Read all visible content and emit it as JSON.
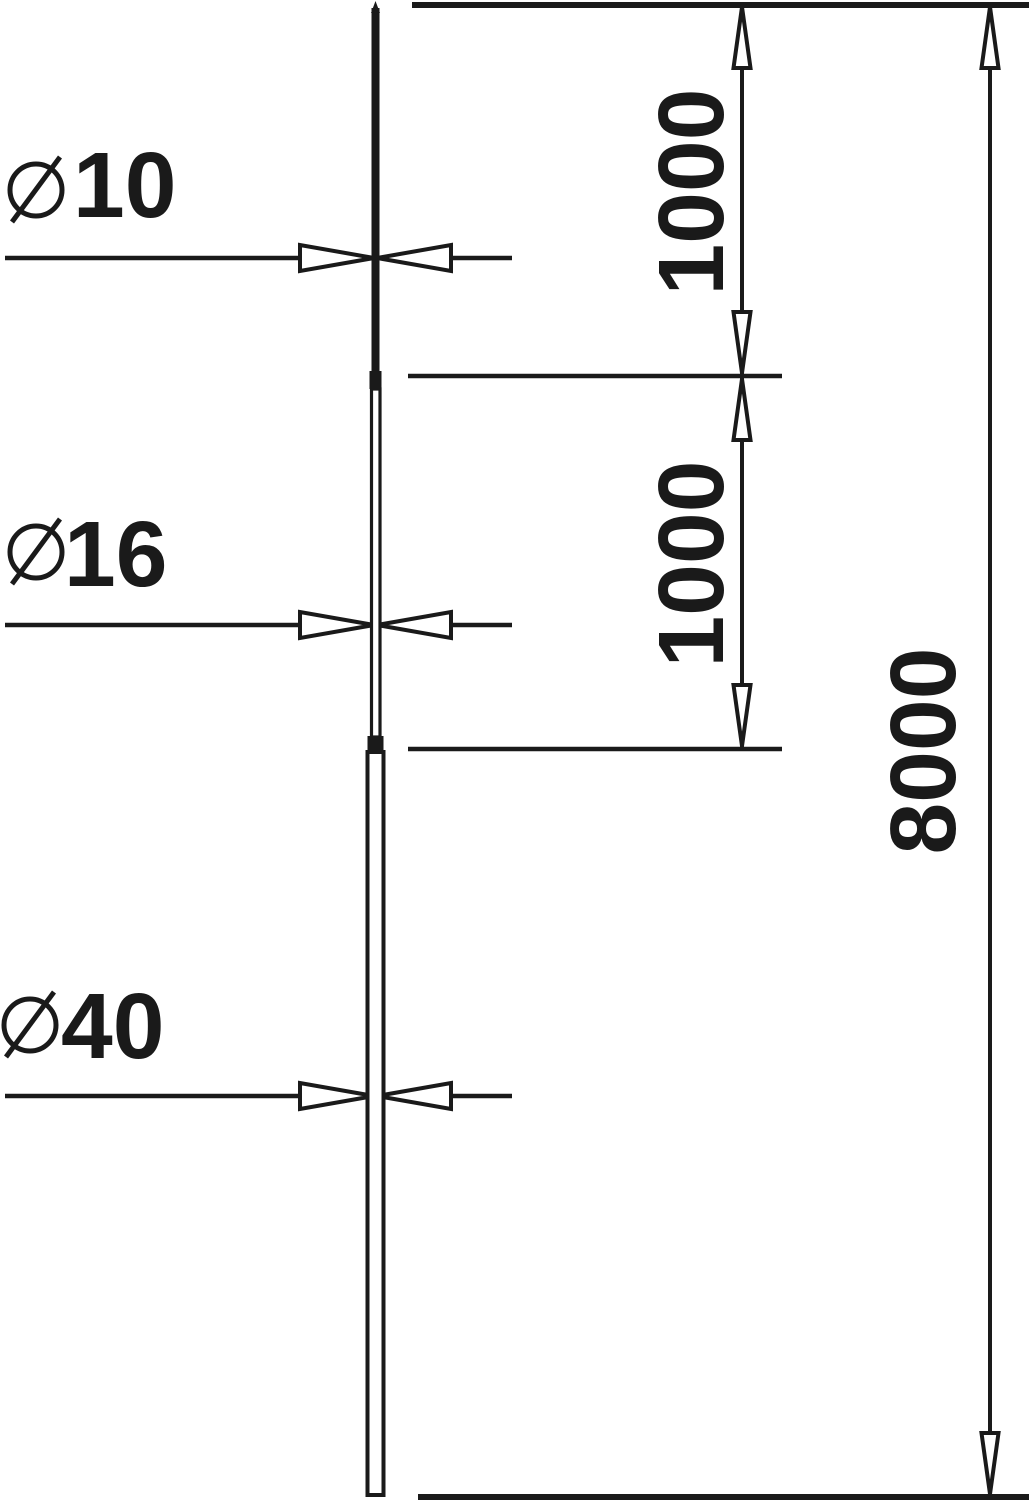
{
  "diagram": {
    "type": "technical-dimension-drawing",
    "background_color": "#ffffff",
    "ink_color": "#1a1a1a",
    "diameter_labels": [
      {
        "symbol": "⌀",
        "value": "10"
      },
      {
        "symbol": "⌀",
        "value": "16"
      },
      {
        "symbol": "⌀",
        "value": "40"
      }
    ],
    "length_dimensions": [
      {
        "value": "1000"
      },
      {
        "value": "1000"
      },
      {
        "value": "8000"
      }
    ]
  }
}
